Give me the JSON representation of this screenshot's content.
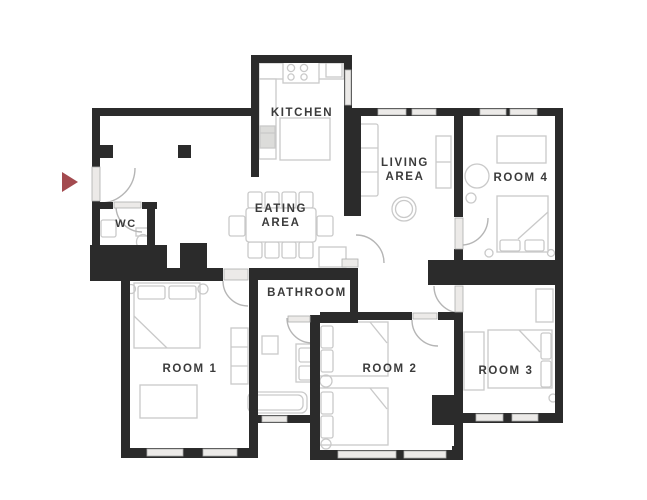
{
  "floor_plan": {
    "labels": {
      "kitchen": "KITCHEN",
      "living_line1": "LIVING",
      "living_line2": "AREA",
      "eating_line1": "EATING",
      "eating_line2": "AREA",
      "room4": "ROOM 4",
      "wc": "WC",
      "bathroom": "BATHROOM",
      "room1": "ROOM 1",
      "room2": "ROOM 2",
      "room3": "ROOM 3"
    },
    "colors": {
      "wall": "#2b2b2b",
      "entry_arrow": "#a34a4f",
      "furniture_outline": "#c9c9c9",
      "window_fill": "#eceae8",
      "label_text": "#3b3b3b",
      "background": "#ffffff"
    },
    "entry_arrow": {
      "direction": "right"
    }
  }
}
